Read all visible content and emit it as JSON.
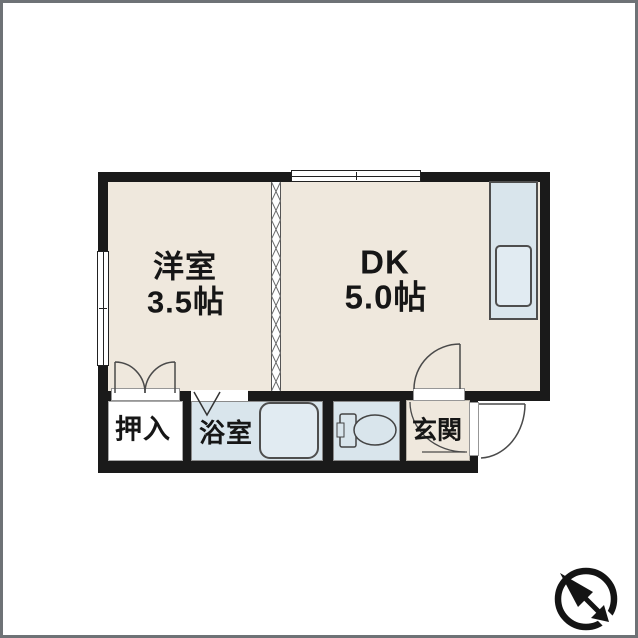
{
  "plan": {
    "rooms": {
      "western": {
        "name": "洋室",
        "size": "3.5帖"
      },
      "dk": {
        "name": "DK",
        "size": "5.0帖"
      },
      "closet": {
        "name": "押入"
      },
      "bathroom": {
        "name": "浴室"
      },
      "entrance": {
        "name": "玄関"
      }
    },
    "fixtures": {
      "kitchen_counter": "kitchen-counter-with-sink",
      "bathtub": "bathtub",
      "toilet": "toilet"
    },
    "compass": "north-arrow-pointing-upper-left"
  },
  "colors": {
    "wall": "#1a1a1a",
    "room_fill": "#efe8dd",
    "wet_fill": "#d9e5ec",
    "tub_fill": "#e1ebf2",
    "frame": "#6e7276",
    "line": "#4a4a4a"
  }
}
